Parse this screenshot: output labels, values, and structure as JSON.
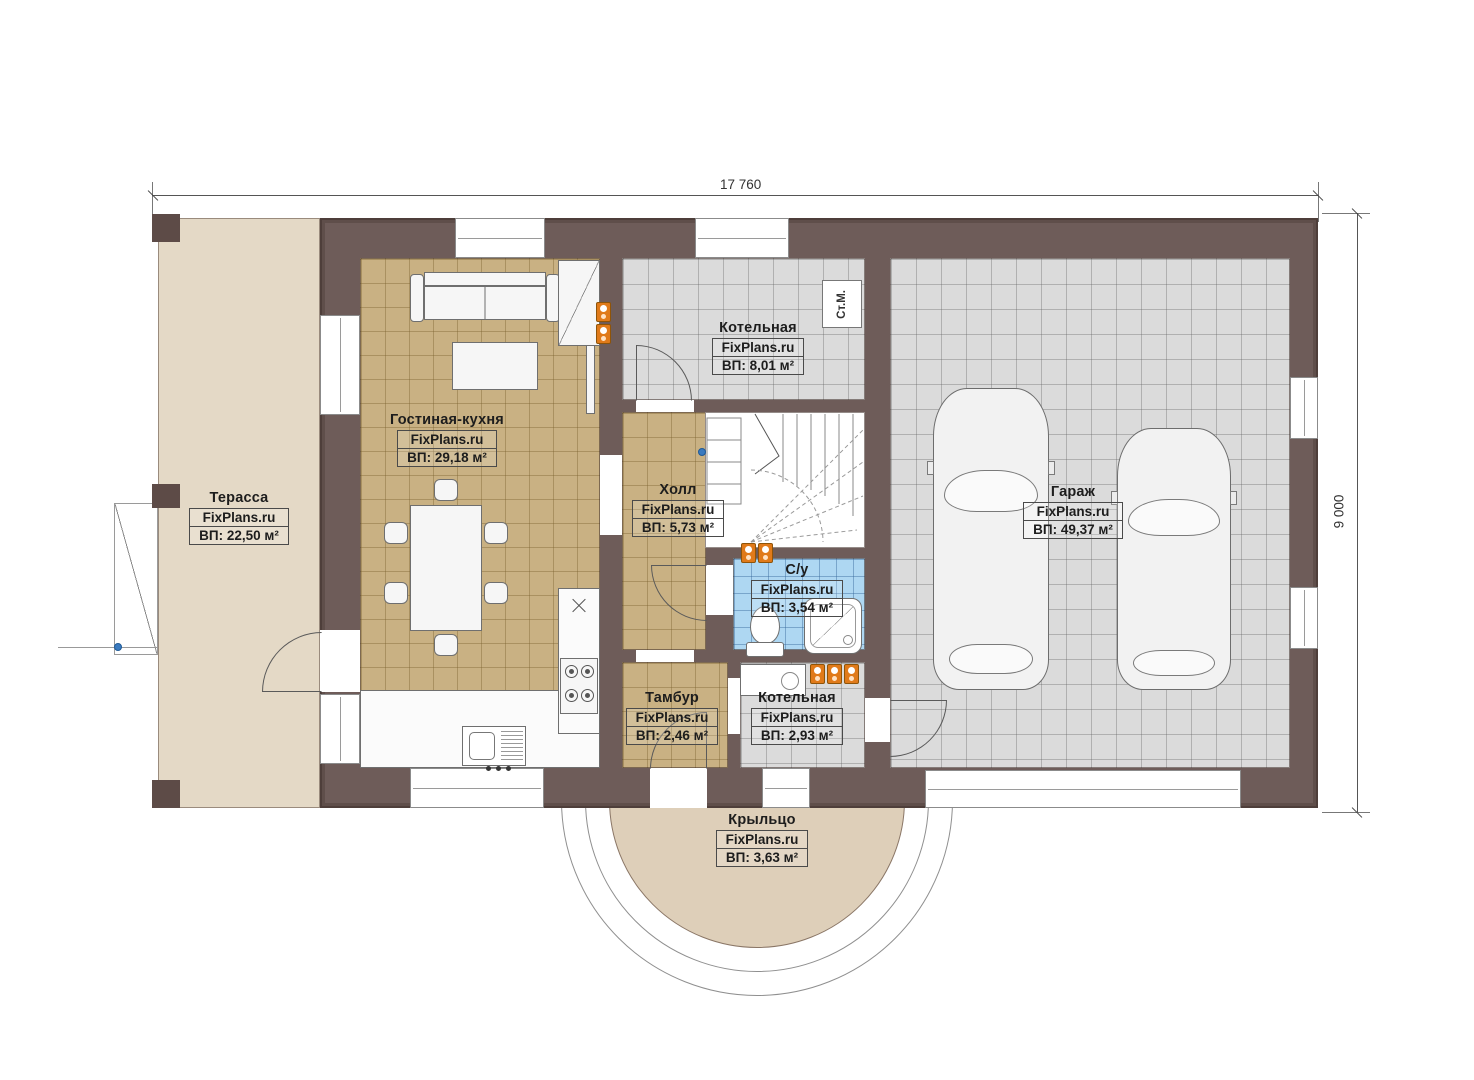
{
  "dims": {
    "top": "17 760",
    "right": "9 000"
  },
  "rooms": {
    "terrace": {
      "name": "Терасса",
      "site": "FixPlans.ru",
      "area": "ВП: 22,50 м²"
    },
    "living": {
      "name": "Гостиная-кухня",
      "site": "FixPlans.ru",
      "area": "ВП: 29,18 м²"
    },
    "boiler_top": {
      "name": "Котельная",
      "site": "FixPlans.ru",
      "area": "ВП: 8,01 м²"
    },
    "hall": {
      "name": "Холл",
      "site": "FixPlans.ru",
      "area": "ВП: 5,73 м²"
    },
    "bathroom": {
      "name": "С/у",
      "site": "FixPlans.ru",
      "area": "ВП: 3,54 м²"
    },
    "vestibule": {
      "name": "Тамбур",
      "site": "FixPlans.ru",
      "area": "ВП: 2,46 м²"
    },
    "boiler_low": {
      "name": "Котельная",
      "site": "FixPlans.ru",
      "area": "ВП: 2,93 м²"
    },
    "garage": {
      "name": "Гараж",
      "site": "FixPlans.ru",
      "area": "ВП: 49,37 м²"
    },
    "porch": {
      "name": "Крыльцо",
      "site": "FixPlans.ru",
      "area": "ВП: 3,63 м²"
    }
  },
  "equipment": {
    "washing_machine": "Ст.М."
  },
  "colors": {
    "wall": "#6e5c59",
    "tile_tan": "#c9b183",
    "tile_gray": "#dbdbdb",
    "tile_blue": "#aed7f2",
    "terrace": "#e4d9c6",
    "porch": "#decfb9",
    "radiator": "#e07a1a"
  }
}
